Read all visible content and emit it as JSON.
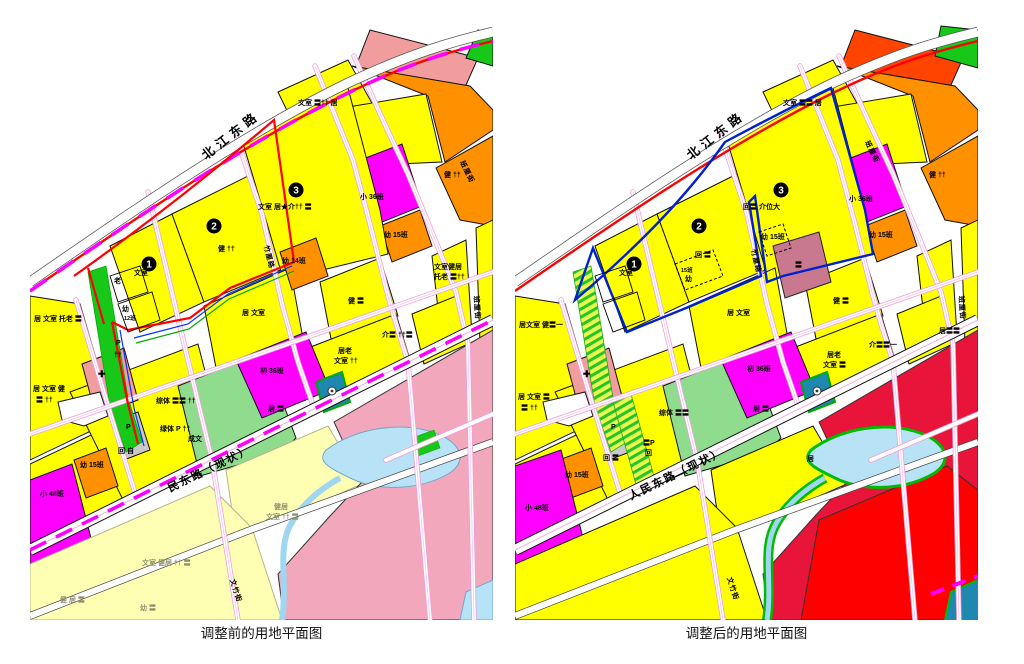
{
  "captions": {
    "before": "调整前的用地平面图",
    "after": "调整后的用地平面图"
  },
  "roads": {
    "beijiang": "北江东路",
    "renmin": "人民东路（现状）",
    "renmin_before": "民东路（现状）",
    "wenzhu": "文竹街",
    "banli": "班厘街",
    "zhuli": "竹厘路"
  },
  "plots": {
    "n1": "1",
    "n2": "2",
    "n3": "3"
  },
  "palette": {
    "residential_yellow": "#ffff00",
    "pale_yellow": "#ffffb3",
    "orange": "#ff9100",
    "deep_orange": "#ff4400",
    "magenta": "#ff00ff",
    "mauve": "#c9798f",
    "salmon": "#f29d9d",
    "pink_zone": "#f3a7bd",
    "crimson": "#e81439",
    "red": "#ff0000",
    "green": "#18c818",
    "light_green": "#8fdc8f",
    "water_blue": "#b8e2f5",
    "teal_parcel": "#1e88b0",
    "grey_parcel": "#c9c9c9",
    "road_red_line": "#ff0000",
    "boundary_blue": "#0022cc",
    "street_pink": "#ef9ed8",
    "adjust_dash_magenta": "#ff00ff"
  },
  "before": {
    "labels": [
      "文室",
      "老",
      "幼",
      "健 ††",
      "文室 居★介†† 〓",
      "文室 〓†† 居",
      "健 ††",
      "小 36班",
      "幼 15班",
      "文室健居",
      "托老 〓††",
      "健 〓",
      "居 文室",
      "幼 14班",
      "居老",
      "文室 ††",
      "介〓 ††〓",
      "居 文室 托老 〓",
      "居 文室 健",
      "〓 ††",
      "P",
      "††",
      "✚",
      "综体 〓〓 ††",
      "绿体 P ††",
      "成文",
      "P",
      "回 自",
      "幼 15班",
      "小 48班",
      "初 36班",
      "居 〓",
      "健居",
      "文室 †† 〓",
      "文室 健居 †† 〓",
      "健 居 〓",
      "幼 〓",
      "12班"
    ]
  },
  "after": {
    "labels": [
      "文室",
      "回 〓",
      "15班",
      "幼",
      "回〓 介位大",
      "文室 〓〓 居",
      "幼 15班",
      "〓",
      "小 36班",
      "幼 15班",
      "居老",
      "文室 〓",
      "介〓〓一",
      "健 〓",
      "居 文室",
      "居文室 健〓一",
      "居 文室 〓",
      "〓 ††",
      "✚",
      "综体 〓〓",
      "〓P",
      "回",
      "回 〓",
      "P",
      "幼 15班",
      "小 48班",
      "初 36班",
      "居 〓",
      "居",
      "居〓〓",
      "健 ††"
    ]
  }
}
